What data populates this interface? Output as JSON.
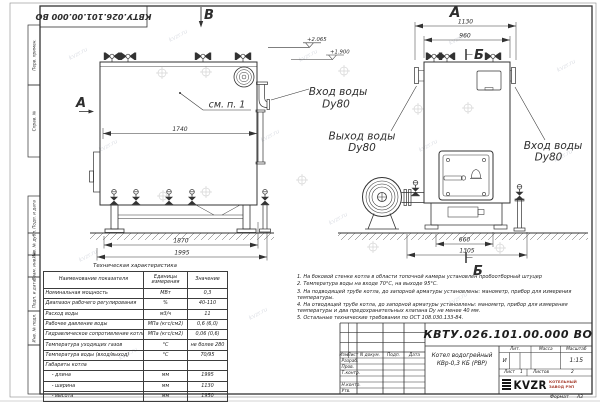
{
  "stamp_code": "КВТУ.026.101.00.000  ВО",
  "margin": {
    "labels": [
      "Перв. примен.",
      "Справ. №",
      "Подп. и дата",
      "Инв. № дубл.",
      "Взам. инв. №",
      "Подп. и дата",
      "Инв. № подл."
    ]
  },
  "drawing": {
    "view_front_label": "В",
    "view_front_arrow_label": "А",
    "view_side_label": "А",
    "section_top": "Б",
    "section_bottom": "Б",
    "callout": "см. п. 1",
    "elev1": "+2.065",
    "elev2": "+1.900",
    "dim_1740": "1740",
    "dim_1870": "1870",
    "dim_1995": "1995",
    "dim_1130": "1130",
    "dim_960": "960",
    "dim_660": "660",
    "dim_1305": "1305",
    "inlet1_l1": "Вход воды",
    "inlet1_l2": "Dy80",
    "outlet_l1": "Выход воды",
    "outlet_l2": "Dy80",
    "inlet2_l1": "Вход воды",
    "inlet2_l2": "Dy80",
    "watermark": "kvzr.ru"
  },
  "tech_table": {
    "title": "Техническая характеристика",
    "col_name": "Наименование показателя",
    "col_units": "Единицы измерения",
    "col_value": "Значение",
    "rows": [
      [
        "Номинальная мощность",
        "МВт",
        "0,3"
      ],
      [
        "Диапазон рабочего регулирования",
        "%",
        "40-110"
      ],
      [
        "Расход воды",
        "м3/ч",
        "11"
      ],
      [
        "Рабочее давление воды",
        "МПа (кгс/см2)",
        "0,6 (6,0)"
      ],
      [
        "Гидравлическое сопротивление котла",
        "МПа (кгс/см2)",
        "0,06 (0,6)"
      ],
      [
        "Температура уходящих газов",
        "°С",
        "не более 280"
      ],
      [
        "Температура воды (вход/выход)",
        "°С",
        "70/95"
      ],
      [
        "Габариты котла",
        "",
        ""
      ],
      [
        "    - длина",
        "мм",
        "1995"
      ],
      [
        "    - ширина",
        "мм",
        "1130"
      ],
      [
        "    - высота",
        "мм",
        "1950"
      ]
    ]
  },
  "notes": [
    "1.  На боковой стенке котла в области топочной камеры установлен пробоотборный штуцер",
    "2.  Температура воды на входе 70°С, на выходе 95°С.",
    "3.  На подводящей трубе котла, до запорной арматуры установлены: манометр, прибор для измерения температуры.",
    "4.  На отводящей трубе котла, до запорной арматуры установлены: манометр, прибор для измерения температуры и два предохранительных клапана Dу не менее 40 мм.",
    "5.  Остальные технические требования по ОСТ 108.030.133-84."
  ],
  "title_block": {
    "code": "КВТУ.026.101.00.000  ВО",
    "name1": "Котел водогрейный",
    "name2": "КВр-0,3 КБ  (РВР)",
    "col_izm": "Изм.",
    "col_list": "Лист",
    "col_ndoc": "N докум.",
    "col_podp": "Подп.",
    "col_data": "Дата",
    "row_razrab": "Разраб.",
    "row_prov": "Пров.",
    "row_tkontr": "Т.контр.",
    "row_nkontr": "Н.контр.",
    "row_utv": "Утв.",
    "lit_header": "Лит.",
    "massa_header": "Масса",
    "masshtab_header": "Масштаб",
    "lit_value": "И",
    "masshtab_value": "1:15",
    "sheet_label": "Лист",
    "sheet_num": "1",
    "sheets_label": "Листов",
    "sheets_num": "2",
    "logo_text": "KVZR",
    "logo_sub1": "КОТЕЛЬНЫЙ",
    "logo_sub2": "ЗАВОД РЭП",
    "format_label": "Формат",
    "format_value": "А3"
  },
  "colors": {
    "line": "#333333",
    "accent_red": "#a84334",
    "paper": "#ffffff"
  }
}
